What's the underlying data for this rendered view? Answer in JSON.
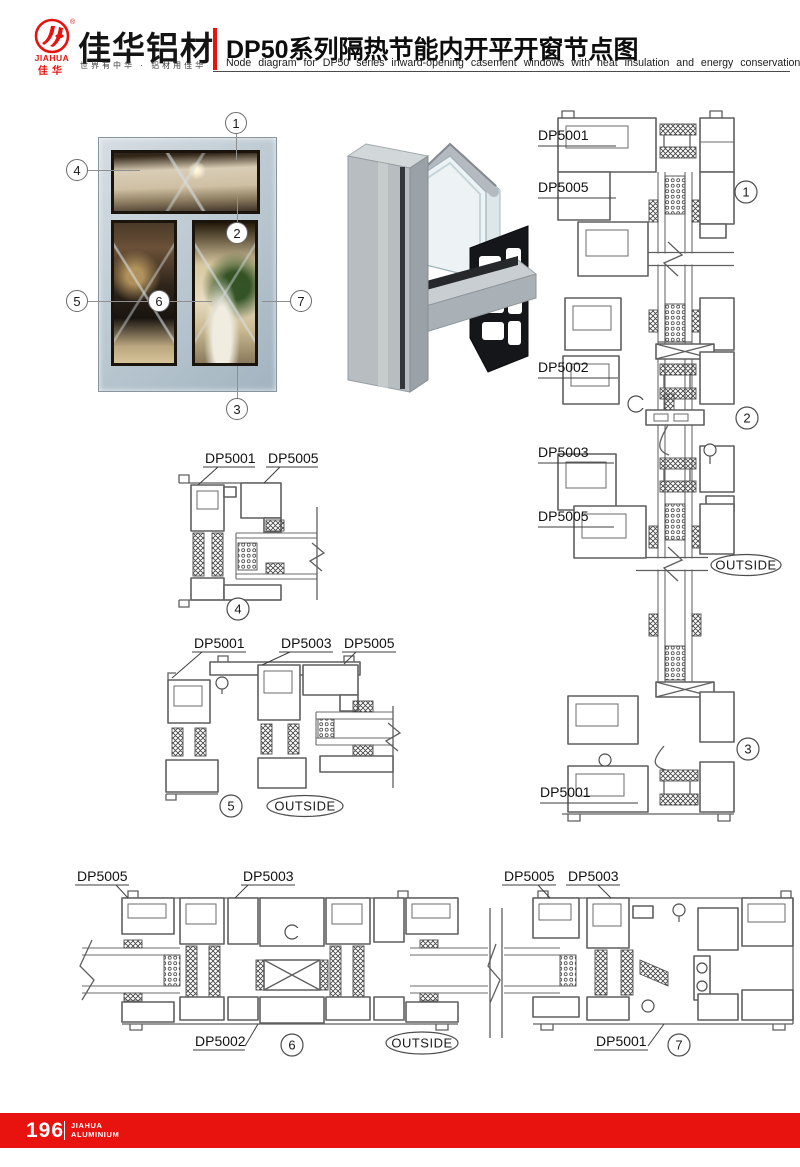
{
  "header": {
    "logo": {
      "brand_en": "JIAHUA",
      "brand_cn": "佳华",
      "reg_mark": "®"
    },
    "brand_title": "佳华铝材",
    "brand_slogan": "世界有中华 · 铝材用佳华",
    "title_cn": "DP50系列隔热节能内开平开窗节点图",
    "title_en": "Node diagram for DP50 series inward-opening casement windows with heat insulation and energy conservation"
  },
  "photo": {
    "callouts": [
      {
        "n": "1"
      },
      {
        "n": "2"
      },
      {
        "n": "3"
      },
      {
        "n": "4"
      },
      {
        "n": "5"
      },
      {
        "n": "6"
      },
      {
        "n": "7"
      }
    ]
  },
  "diagrams": {
    "vertical_section": {
      "labels": [
        "DP5001",
        "DP5005",
        "DP5002",
        "DP5003",
        "DP5005",
        "DP5001"
      ],
      "markers": [
        "1",
        "2",
        "3"
      ],
      "outside": "OUTSIDE"
    },
    "detail_4": {
      "labels": [
        "DP5001",
        "DP5005"
      ],
      "marker": "4"
    },
    "detail_5": {
      "labels": [
        "DP5001",
        "DP5003",
        "DP5005"
      ],
      "marker": "5",
      "outside": "OUTSIDE"
    },
    "bottom_section": {
      "left_labels": [
        "DP5005",
        "DP5003",
        "DP5002"
      ],
      "right_labels": [
        "DP5005",
        "DP5003",
        "DP5001"
      ],
      "markers": [
        "6",
        "7"
      ],
      "outside": "OUTSIDE"
    }
  },
  "footer": {
    "page_number": "196",
    "brand_line1": "JIAHUA",
    "brand_line2": "ALUMINIUM"
  },
  "colors": {
    "accent_red": "#e8120f",
    "drawing_line": "#5f5f5f",
    "window_frame": "#b9c6d0"
  }
}
